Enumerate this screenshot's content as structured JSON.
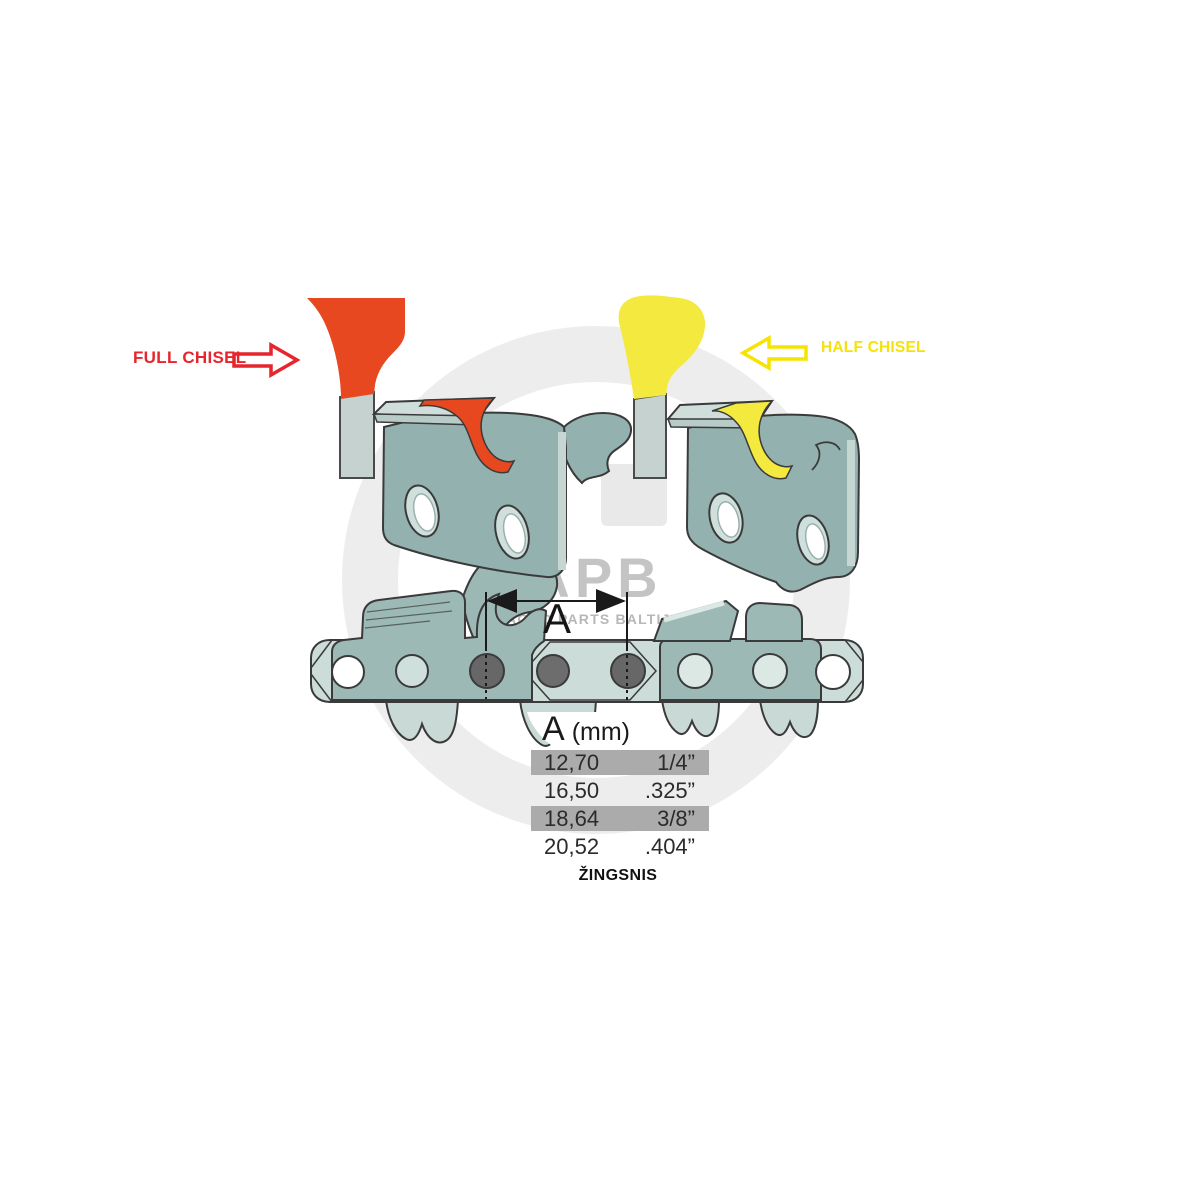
{
  "labels": {
    "full_chisel": "FULL CHISEL",
    "half_chisel": "HALF CHISEL",
    "dimension": "A",
    "pitch_caption": "ŽINGSNIS"
  },
  "table": {
    "header": {
      "symbol": "A",
      "unit": "(mm)"
    },
    "rows": [
      {
        "mm": "12,70",
        "inch": "1/4”",
        "highlighted": true
      },
      {
        "mm": "16,50",
        "inch": ".325”",
        "highlighted": false
      },
      {
        "mm": "18,64",
        "inch": "3/8”",
        "highlighted": true
      },
      {
        "mm": "20,52",
        "inch": ".404”",
        "highlighted": false
      }
    ]
  },
  "watermark": {
    "abbr": "APB",
    "name": "AGRO PARTS BALTIJA"
  },
  "colors": {
    "full_chisel_accent": "#e6252d",
    "full_chisel_fill": "#e8481f",
    "half_chisel_accent": "#f6e400",
    "half_chisel_fill": "#f4e93e",
    "steel_light": "#ccdcd8",
    "steel_mid": "#93b1ae",
    "rivet_gray": "#676767",
    "table_highlight": "#ababab",
    "watermark_gray": "#ededed"
  }
}
